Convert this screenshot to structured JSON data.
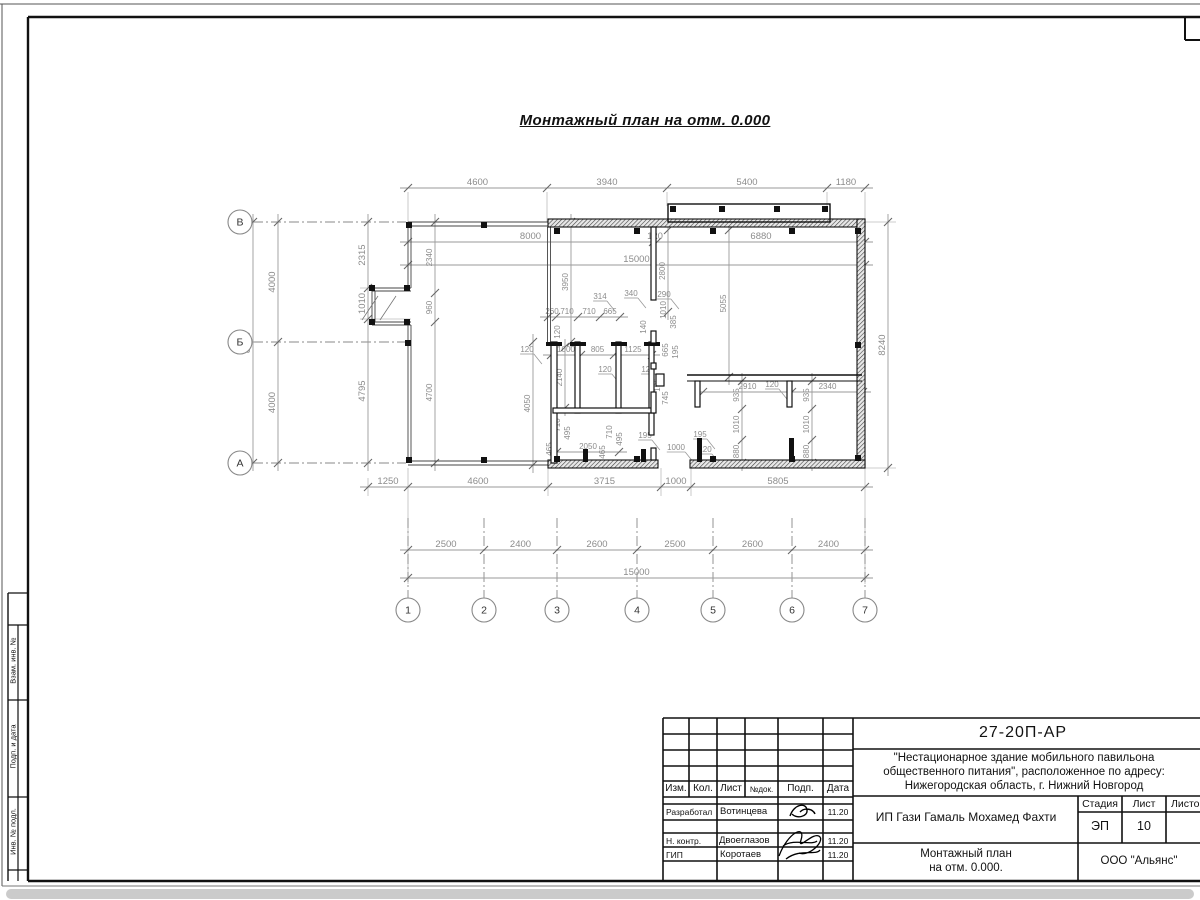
{
  "title": "Монтажный план на отм. 0.000",
  "plan": {
    "grid_columns": [
      "1",
      "2",
      "3",
      "4",
      "5",
      "6",
      "7"
    ],
    "grid_rows": [
      "В",
      "Б",
      "А"
    ],
    "dim_chains": {
      "top": [
        "4600",
        "3940",
        "5400",
        "1180"
      ],
      "hall_width": [
        "8000",
        "120",
        "6880"
      ],
      "total_width_upper": [
        "15000"
      ],
      "partition_top": [
        "260",
        "710",
        "710",
        "665"
      ],
      "rooms": [
        "1000",
        "805",
        "1125"
      ],
      "room_bottom": [
        "2050"
      ],
      "counter": [
        "2910",
        "2340"
      ],
      "bottom_offsets": [
        "1250",
        "4600",
        "3715",
        "1000",
        "5805"
      ],
      "column_spacing": [
        "2500",
        "2400",
        "2600",
        "2500",
        "2600",
        "2400"
      ],
      "total_width_lower": [
        "15000"
      ],
      "left_outer": [
        "8000"
      ],
      "left_inner": [
        "4000",
        "4000"
      ],
      "left_detail": [
        "2315",
        "1010",
        "4795"
      ],
      "left_terrace": [
        "2340",
        "960",
        "4700"
      ],
      "right": [
        "8240"
      ],
      "v_4050": [
        "4050"
      ],
      "v_3950": [
        "3950"
      ],
      "v_2800": [
        "2800"
      ],
      "v_5055": [
        "5055"
      ],
      "v_2140": [
        "2140"
      ],
      "leg_left": [
        "935",
        "1010",
        "880"
      ],
      "leg_right": [
        "935",
        "1010",
        "880"
      ]
    },
    "free_labels": [
      "314",
      "340",
      "290",
      "140",
      "1010",
      "385",
      "665",
      "195",
      "745",
      "195",
      "120",
      "120",
      "120",
      "710",
      "495",
      "465",
      "710",
      "495",
      "465",
      "195",
      "1000",
      "195",
      "120",
      "120",
      "120"
    ]
  },
  "title_block": {
    "doc_number": "27-20П-АР",
    "description_lines": [
      "\"Нестационарное здание мобильного павильона",
      "общественного питания\", расположенное по адресу:",
      "Нижегородская область, г. Нижний Новгород"
    ],
    "client": "ИП Гази Гамаль Мохамед Фахти",
    "sheet_name_line1": "Монтажный план",
    "sheet_name_line2": "на отм. 0.000.",
    "organization": "ООО \"Альянс\"",
    "headers": {
      "izm": "Изм.",
      "kol": "Кол.",
      "list": "Лист",
      "ndok": "№док.",
      "podp": "Подп.",
      "data": "Дата",
      "stadia": "Стадия",
      "sheet": "Лист",
      "sheets": "Листов"
    },
    "stadia_value": "ЭП",
    "sheet_value": "10",
    "sheets_value": "",
    "rows": [
      {
        "role": "Разработал",
        "name": "Вотинцева",
        "date": "11.20"
      },
      {
        "role": "Н. контр.",
        "name": "Двоеглазов",
        "date": "11.20"
      },
      {
        "role": "ГИП",
        "name": "Коротаев",
        "date": "11.20"
      }
    ]
  },
  "frame": {
    "side_labels": [
      "Взам. инв. №",
      "Подп. и дата",
      "Инв. № подл."
    ]
  },
  "colors": {
    "line": "#111111",
    "dim": "#8c8c8c"
  }
}
